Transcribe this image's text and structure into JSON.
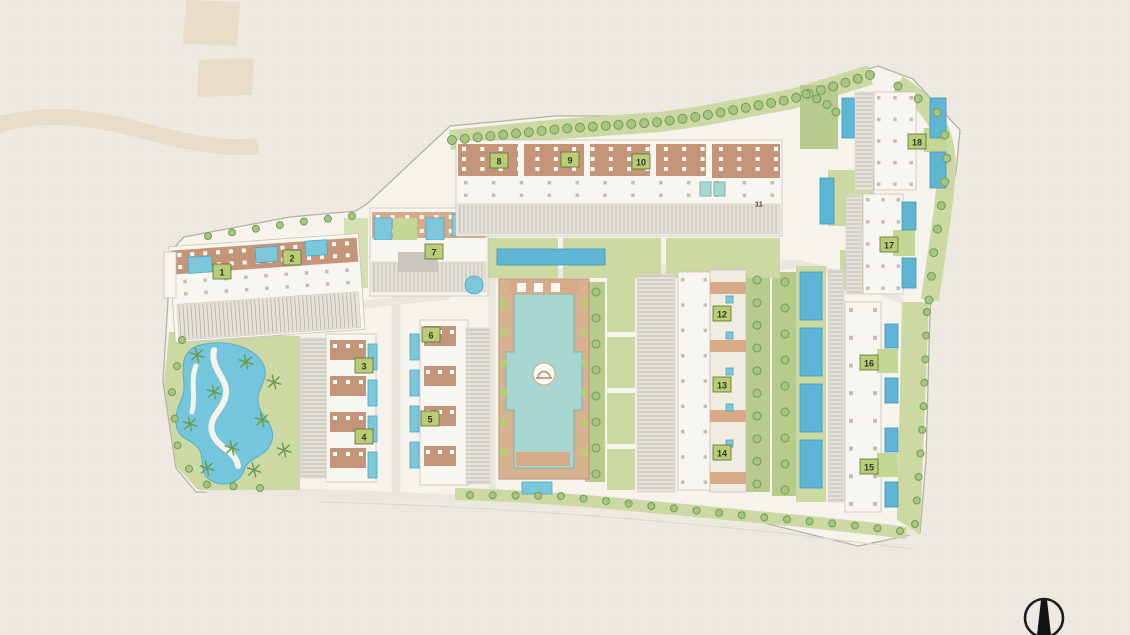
{
  "page": {
    "background": "#eeeae2"
  },
  "colors": {
    "decor_beige": "#e7dac3",
    "parcel_fill": "#f5f3ec",
    "parcel_stroke": "#b3b1a7",
    "road": "#eae7de",
    "lawn": "#cdd9a3",
    "lawn_bright": "#c5d795",
    "planting": "#b7cb8d",
    "tree_fill": "#a8c580",
    "tree_stroke": "#739c55",
    "palm": "#6f9a4f",
    "building_tan": "#c49579",
    "building_light": "#d8ab88",
    "unit_white": "#fbfaf6",
    "furniture_gray": "#c2c0b5",
    "stripe_bg": "#e4e2d9",
    "stripe_line": "#9d9b90",
    "pool": "#7cc7dc",
    "pool_dark": "#5fb6d4",
    "pool_teal": "#a7d7d0",
    "lagoon": "#74c6dd",
    "deck_tan": "#d8b392",
    "badge_green": "#b9cc76",
    "badge_border": "#5c6e33",
    "compass": "#1d1d1d"
  },
  "plan": {
    "buildings": [
      {
        "label": "1",
        "x": 222,
        "y": 272,
        "badge": true
      },
      {
        "label": "2",
        "x": 292,
        "y": 258,
        "badge": true
      },
      {
        "label": "3",
        "x": 364,
        "y": 366,
        "badge": true
      },
      {
        "label": "4",
        "x": 364,
        "y": 437,
        "badge": true
      },
      {
        "label": "5",
        "x": 430,
        "y": 419,
        "badge": true
      },
      {
        "label": "6",
        "x": 431,
        "y": 335,
        "badge": true
      },
      {
        "label": "7",
        "x": 434,
        "y": 252,
        "badge": true
      },
      {
        "label": "8",
        "x": 499,
        "y": 161,
        "badge": true
      },
      {
        "label": "9",
        "x": 570,
        "y": 160,
        "badge": true
      },
      {
        "label": "10",
        "x": 641,
        "y": 162,
        "badge": true
      },
      {
        "label": "11",
        "x": 759,
        "y": 203,
        "badge": false
      },
      {
        "label": "12",
        "x": 722,
        "y": 314,
        "badge": true
      },
      {
        "label": "13",
        "x": 722,
        "y": 385,
        "badge": true
      },
      {
        "label": "14",
        "x": 722,
        "y": 453,
        "badge": true
      },
      {
        "label": "15",
        "x": 869,
        "y": 467,
        "badge": true
      },
      {
        "label": "16",
        "x": 869,
        "y": 363,
        "badge": true
      },
      {
        "label": "17",
        "x": 889,
        "y": 245,
        "badge": true
      },
      {
        "label": "18",
        "x": 917,
        "y": 142,
        "badge": true
      }
    ],
    "tree_rows": [
      {
        "name": "top-tree-row",
        "pts": [
          [
            452,
            140
          ],
          [
            560,
            129
          ],
          [
            660,
            122
          ],
          [
            702,
            116
          ],
          [
            792,
            99
          ],
          [
            870,
            75
          ]
        ],
        "n": 34,
        "r": 4.5
      },
      {
        "name": "right-upper-tree-row",
        "pts": [
          [
            898,
            86
          ],
          [
            936,
            110
          ],
          [
            948,
            145
          ],
          [
            944,
            190
          ],
          [
            934,
            250
          ],
          [
            929,
            300
          ]
        ],
        "n": 11,
        "r": 4
      },
      {
        "name": "right-lower-tree-row",
        "pts": [
          [
            927,
            312
          ],
          [
            923,
            420
          ],
          [
            915,
            524
          ]
        ],
        "n": 10,
        "r": 3.5
      },
      {
        "name": "bottom-tree-row",
        "pts": [
          [
            470,
            495
          ],
          [
            560,
            496
          ],
          [
            660,
            507
          ],
          [
            760,
            517
          ],
          [
            850,
            525
          ],
          [
            900,
            531
          ]
        ],
        "n": 20,
        "r": 3.5
      },
      {
        "name": "park-edge-trees",
        "pts": [
          [
            182,
            340
          ],
          [
            172,
            392
          ],
          [
            178,
            450
          ],
          [
            198,
            484
          ],
          [
            260,
            488
          ]
        ],
        "n": 9,
        "r": 3.5
      },
      {
        "name": "bosque-trees",
        "pts": [
          [
            757,
            280
          ],
          [
            757,
            484
          ]
        ],
        "n": 10,
        "r": 4
      },
      {
        "name": "garden-column-trees",
        "pts": [
          [
            785,
            282
          ],
          [
            785,
            490
          ]
        ],
        "n": 9,
        "r": 4
      },
      {
        "name": "courtyard-garden-trees",
        "pts": [
          [
            596,
            292
          ],
          [
            596,
            474
          ]
        ],
        "n": 8,
        "r": 4
      },
      {
        "name": "northeast-garden-trees",
        "pts": [
          [
            806,
            94
          ],
          [
            824,
            102
          ],
          [
            836,
            112
          ]
        ],
        "n": 4,
        "r": 4
      },
      {
        "name": "top-left-cluster-trees",
        "pts": [
          [
            208,
            236
          ],
          [
            300,
            222
          ],
          [
            352,
            216
          ]
        ],
        "n": 7,
        "r": 3.5
      }
    ],
    "palms": [
      [
        197,
        355
      ],
      [
        214,
        392
      ],
      [
        190,
        424
      ],
      [
        232,
        448
      ],
      [
        254,
        470
      ],
      [
        207,
        468
      ],
      [
        262,
        420
      ],
      [
        274,
        382
      ],
      [
        246,
        362
      ],
      [
        284,
        450
      ]
    ]
  },
  "compass": {
    "type": "north-arrow"
  }
}
